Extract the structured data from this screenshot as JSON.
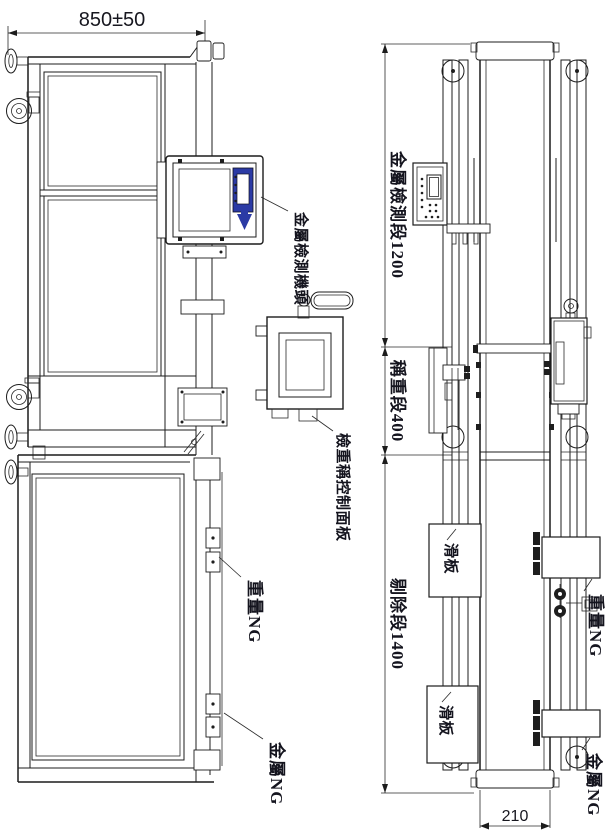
{
  "colors": {
    "line": "#1c1c1c",
    "text": "#14141e",
    "accent_blue": "#2b3aa5",
    "background": "#ffffff"
  },
  "side_view": {
    "width_dim": "850±50",
    "labels": {
      "detector_head": "金屬檢測機頭",
      "control_panel": "檢重稱控制面板",
      "weight_ng": "重量NG",
      "metal_ng": "金屬NG"
    }
  },
  "plan_view": {
    "sections": {
      "metal_detection": "金屬檢測段1200",
      "weighing": "稱重段400",
      "rejection": "剔除段1400"
    },
    "labels": {
      "slide_plate_upper": "滑板",
      "slide_plate_lower": "滑板",
      "weight_ng": "重量NG",
      "metal_ng": "金屬NG"
    },
    "belt_width_dim": "210"
  }
}
